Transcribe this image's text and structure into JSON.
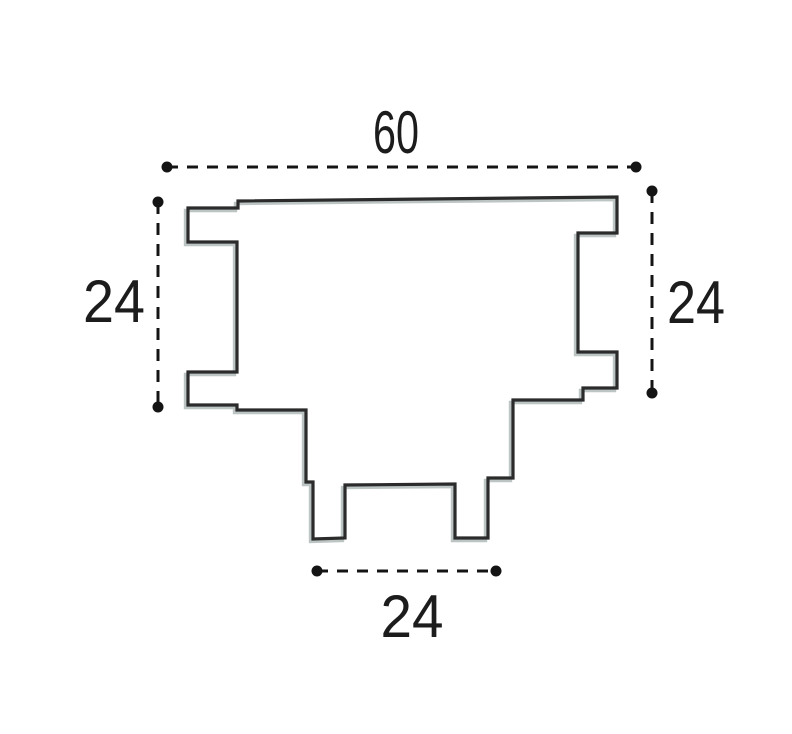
{
  "drawing": {
    "title": "profile-cross-section",
    "stroke_color": "#2b2b2b",
    "shadow_color": "#9aa4a4",
    "dim_color": "#141414",
    "profile_path": "M 238 201 L 617 197 L 617 233 L 578 233 L 578 352 L 617 352 L 617 388 L 583 388 L 583 400 L 513 400 L 513 478 L 488 478 L 488 538 L 455 538 L 455 484 L 345 485 L 345 538 L 313 539 L 313 482 L 306 482 L 306 410 L 237 410 L 237 405 L 188 405 L 188 372 L 237 372 L 237 242 L 188 242 L 188 208 L 238 208 Z",
    "dimensions": {
      "top_width": {
        "label": "60"
      },
      "left_height": {
        "label": "24"
      },
      "right_height": {
        "label": "24"
      },
      "bottom_width": {
        "label": "24"
      }
    }
  }
}
